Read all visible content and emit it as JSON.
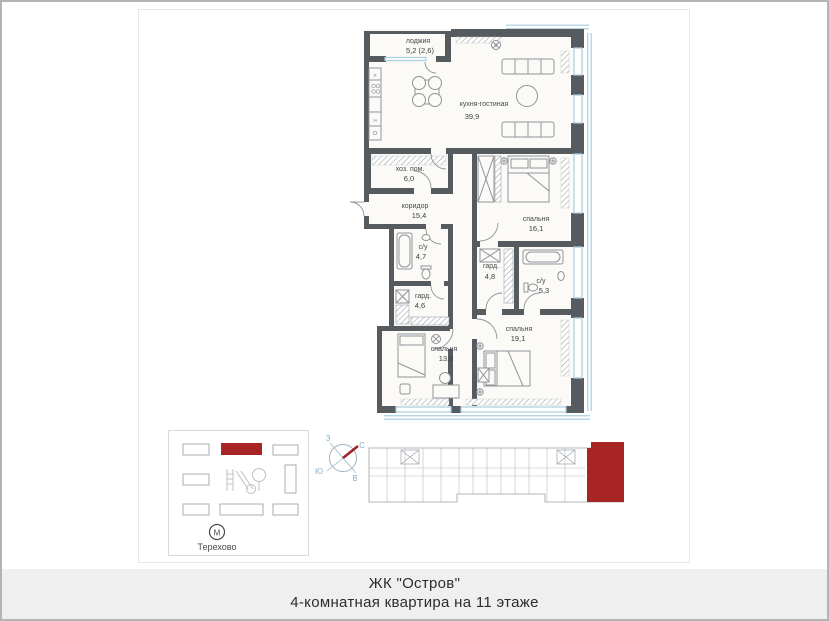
{
  "page": {
    "title_line1": "ЖК \"Остров\"",
    "title_line2": "4-комнатная квартира на 11 этаже"
  },
  "plan": {
    "rooms": [
      {
        "id": "loggia",
        "name": "лоджия",
        "area": "5,2 (2,6)"
      },
      {
        "id": "kitchen-living",
        "name": "кухня-гостиная",
        "area": "39,9"
      },
      {
        "id": "utility",
        "name": "хоз. пом.",
        "area": "6,0"
      },
      {
        "id": "corridor",
        "name": "коридор",
        "area": "15,4"
      },
      {
        "id": "bathroom-1",
        "name": "с/у",
        "area": "4,7"
      },
      {
        "id": "bedroom-1",
        "name": "спальня",
        "area": "16,1"
      },
      {
        "id": "wardrobe-1",
        "name": "гард.",
        "area": "4,8"
      },
      {
        "id": "bathroom-2",
        "name": "с/у",
        "area": "5,3"
      },
      {
        "id": "wardrobe-2",
        "name": "гард.",
        "area": "4,6"
      },
      {
        "id": "bedroom-2",
        "name": "спальня",
        "area": "13,6"
      },
      {
        "id": "bedroom-3",
        "name": "спальня",
        "area": "19,1"
      }
    ]
  },
  "site_plan": {
    "metro_letter": "М",
    "metro_label": "Терехово"
  },
  "compass": {
    "west": "З",
    "north": "С",
    "south": "Ю",
    "east": "В"
  },
  "colors": {
    "accent_red": "#a82526",
    "wall_gray": "#565b60",
    "window_blue": "#a9cde0",
    "floor": "#fbfaf6"
  }
}
